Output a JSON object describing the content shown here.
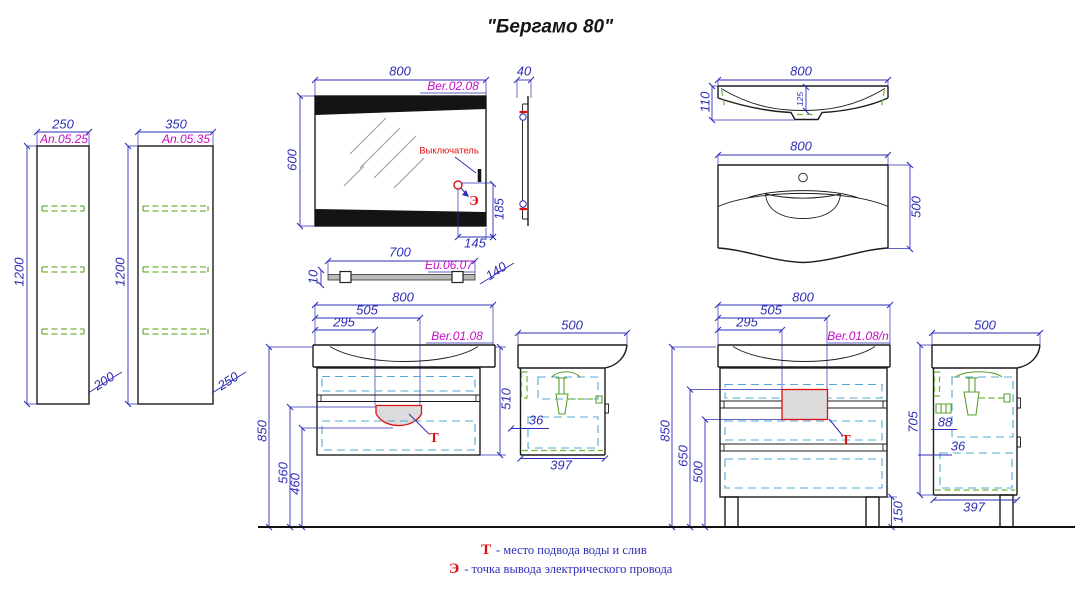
{
  "title": "\"Бергамо 80\"",
  "col_a": {
    "w": "250",
    "art": "An.05.25",
    "h": "1200",
    "d": "200"
  },
  "col_b": {
    "w": "350",
    "art": "An.05.35",
    "h": "1200",
    "d": "250"
  },
  "mirror": {
    "w": "800",
    "art": "Ber.02.08",
    "h": "600",
    "side": "40",
    "switch": "Выключатель",
    "e": "Э",
    "d185": "185",
    "d145": "145"
  },
  "shelf": {
    "w": "700",
    "art": "Eu.06.07",
    "t": "10",
    "d": "140"
  },
  "basin": {
    "w_profile": "800",
    "h": "110",
    "depth_in": "125",
    "w_plan": "800",
    "d": "500"
  },
  "van_a": {
    "w": "800",
    "art": "Ber.01.08",
    "d505": "505",
    "d295": "295",
    "h850": "850",
    "h560": "560",
    "h460": "460",
    "h510": "510",
    "t": "Т"
  },
  "van_a_side": {
    "w": "500",
    "d36": "36",
    "d397": "397"
  },
  "van_b": {
    "w": "800",
    "art": "Ber.01.08/n",
    "d505": "505",
    "d295": "295",
    "h850": "850",
    "h650": "650",
    "h500": "500",
    "h150": "150",
    "t": "Т"
  },
  "van_b_side": {
    "w": "500",
    "h705": "705",
    "d88": "88",
    "d36": "36",
    "d397": "397"
  },
  "legend": {
    "t": "Т",
    "t_text": "- место подвода воды и слив",
    "e": "Э",
    "e_text": "- точка вывода электрического провода"
  },
  "colors": {
    "dimension": "#2e2eb8",
    "article": "#c80ac8",
    "accent": "#e01010",
    "shelf_green": "#76b23a",
    "drawer_cyan": "#53a8d6"
  }
}
